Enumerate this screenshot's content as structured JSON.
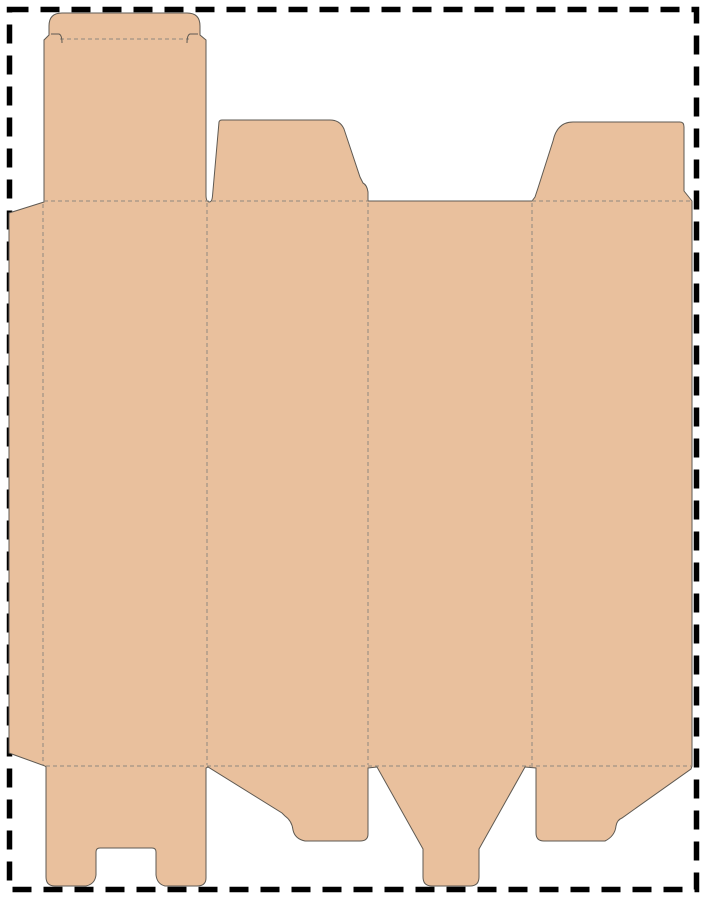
{
  "page": {
    "width": 703,
    "height": 900,
    "background_color": "#ffffff",
    "description": "Folding carton dieline template: tuck-top box with four panels, glue flap, dust flaps and snap-lock bottom"
  },
  "border": {
    "color": "#000000",
    "stroke_width": 5.5,
    "dash_array": "19 12",
    "x": 9.5,
    "y": 9.5,
    "w": 687,
    "h": 880
  },
  "dieline": {
    "fill": "#e9c09d",
    "cut_stroke": "#5e5952",
    "fold_stroke": "#8f897f",
    "outline_path": "M 9 213 L 44 202 L 44 40 L 49 35 L 49 26 Q 49 13 62 13 L 187 13 Q 200 13 200 26 L 200 35 L 206 40 L 206 195 Q 206 202 209.5 202 Q 212 202 212.5 196 L 219 122 Q 219.5 120 222 120 L 330 120 Q 340 120 344 129 L 360 177 L 363 183 Q 367 185 368 192 L 368 201 L 532 201 L 535 197 Q 536 194 538 188 L 553 141 Q 557 122 573 122 L 680 122 Q 684 122 684 127 L 684 191 L 692 201 L 692 766 L 691 769 L 622 818 Q 617 820 616 826 Q 615 836 605 841 L 544 841 Q 536 841 536 833 L 536 768 L 525 767 L 479 849 L 479 877 Q 479 886 470 886 L 432 886 Q 423 886 423 877 L 423 849 L 377 767 L 368 768 L 368 834 Q 368 841 360 841 L 305 841 Q 295 839 293 830 Q 292 821 285 816 L 282 813 L 208 767 L 206 768 L 206 878 Q 206 886 197 886 L 165 886 Q 157 884 156 875 L 156 852 Q 156 848 152 848 L 100 848 Q 96 848 96 852 L 96 875 Q 95 884 86 886 L 55 886 Q 46 886 46 877 L 46 767 L 45 766 L 9 753 Z",
    "folds": [
      {
        "name": "glue-flap-fold",
        "path": "M43 204 L43 765"
      },
      {
        "name": "panel-1-2-fold",
        "path": "M207 203 L207 765"
      },
      {
        "name": "panel-2-3-fold",
        "path": "M368 203 L368 765"
      },
      {
        "name": "panel-3-4-fold",
        "path": "M532 203 L532 765"
      },
      {
        "name": "top-fold",
        "path": "M44 201 L368 201 M532 201 L692 201"
      },
      {
        "name": "bottom-fold",
        "path": "M46 766 L691 766"
      },
      {
        "name": "tuck-flap-fold",
        "path": "M60 39 L189 39"
      }
    ],
    "slits": [
      {
        "name": "tuck-slit-left",
        "path": "M51 34 L59 34 Q62 35 62 43"
      },
      {
        "name": "tuck-slit-right",
        "path": "M198 34 L190 34 Q187 35 187 43"
      }
    ]
  }
}
